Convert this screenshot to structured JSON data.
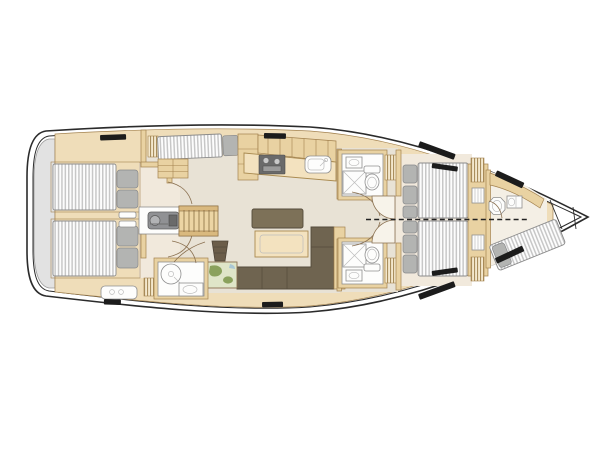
{
  "diagram": {
    "title": "Sailing yacht interior layout plan (top-down deck view)",
    "type": "yacht-floor-plan",
    "orientation": {
      "bow": "right",
      "stern": "left"
    },
    "vessel": {
      "style": "monohull sailing yacht",
      "cabins": 4,
      "heads": 3,
      "dashed_line_meaning": "optional dividing bulkhead splitting the forward owner cabin into two cabins"
    },
    "areas": [
      {
        "id": "swim-platform",
        "label": "Stern swim platform / transom"
      },
      {
        "id": "aft-cabin-port",
        "label": "Aft double cabin (port)",
        "features": [
          "double berth",
          "pillows",
          "louvered locker",
          "door"
        ]
      },
      {
        "id": "aft-cabin-starboard",
        "label": "Aft double cabin (starboard)",
        "features": [
          "double berth",
          "pillows",
          "door"
        ]
      },
      {
        "id": "engine-room",
        "label": "Engine compartment under companionway",
        "features": [
          "engine block"
        ]
      },
      {
        "id": "companionway",
        "label": "Companionway steps",
        "features": [
          "wood treads"
        ]
      },
      {
        "id": "port-settee",
        "label": "Port side settee berth",
        "features": [
          "cushion",
          "pillow",
          "drawer chest"
        ]
      },
      {
        "id": "galley",
        "label": "Galley (port)",
        "features": [
          "stove",
          "sink",
          "overhead lockers"
        ]
      },
      {
        "id": "salon",
        "label": "Salon (starboard)",
        "features": [
          "L-shaped sofa",
          "table",
          "forward bench"
        ]
      },
      {
        "id": "nav-station",
        "label": "Navigation station",
        "features": [
          "chart table with map",
          "navigator seat"
        ]
      },
      {
        "id": "aft-head",
        "label": "Aft bathroom",
        "features": [
          "shower",
          "washbasin",
          "door"
        ]
      },
      {
        "id": "fwd-head-port",
        "label": "Forward bathroom (port)",
        "features": [
          "shower",
          "toilet",
          "washbasin"
        ]
      },
      {
        "id": "fwd-head-starboard",
        "label": "Forward bathroom (starboard)",
        "features": [
          "shower",
          "toilet",
          "washbasin"
        ]
      },
      {
        "id": "owner-cabin",
        "label": "Forward owner cabin",
        "features": [
          "two convertible berths",
          "pillows",
          "wardrobes",
          "optional split bulkhead (dashed)"
        ]
      },
      {
        "id": "bow-cabin",
        "label": "Bow crew cabin",
        "features": [
          "angled single berth",
          "toilet",
          "washbasin"
        ]
      },
      {
        "id": "anchor-locker",
        "label": "Anchor locker / bow peak"
      }
    ],
    "deck_hatches": 8
  },
  "colors": {
    "hull-line": "#2b2b2b",
    "transom": "#e2e2e2",
    "wood-base": "#efddb9",
    "wood-mid": "#e9d2a2",
    "wood-line": "#a3824f",
    "floor-salon": "#e8e2d5",
    "floor-cabin": "#f1e9dc",
    "floor-bow": "#f4efe5",
    "fixture-white": "#fdfdfc",
    "fixture-line": "#8f8f8f",
    "mattress-light": "#fdfdfd",
    "mattress-dark": "#c7c7c7",
    "mattress-line": "#8c8c8c",
    "pillow": "#b3b4b2",
    "pillow-line": "#87888a",
    "sofa": "#6f6450",
    "sofa-line": "#544b3b",
    "bench": "#7d7158",
    "table-wood": "#f3e2bf",
    "table-line": "#a98a50",
    "engine": "#909194",
    "stair-wood": "#ecd5a4",
    "stair-rail": "#d9b97f",
    "stair-line": "#8a6d42",
    "map-bg": "#dfe5c8",
    "map-green": "#8aa15c",
    "map-water": "#aac7d4",
    "hatch-black": "#1c1c1c",
    "dash-line": "#222222",
    "door-fill": "#f7f3ea",
    "door-line": "#8a7050",
    "stool": "#6b5d49"
  }
}
